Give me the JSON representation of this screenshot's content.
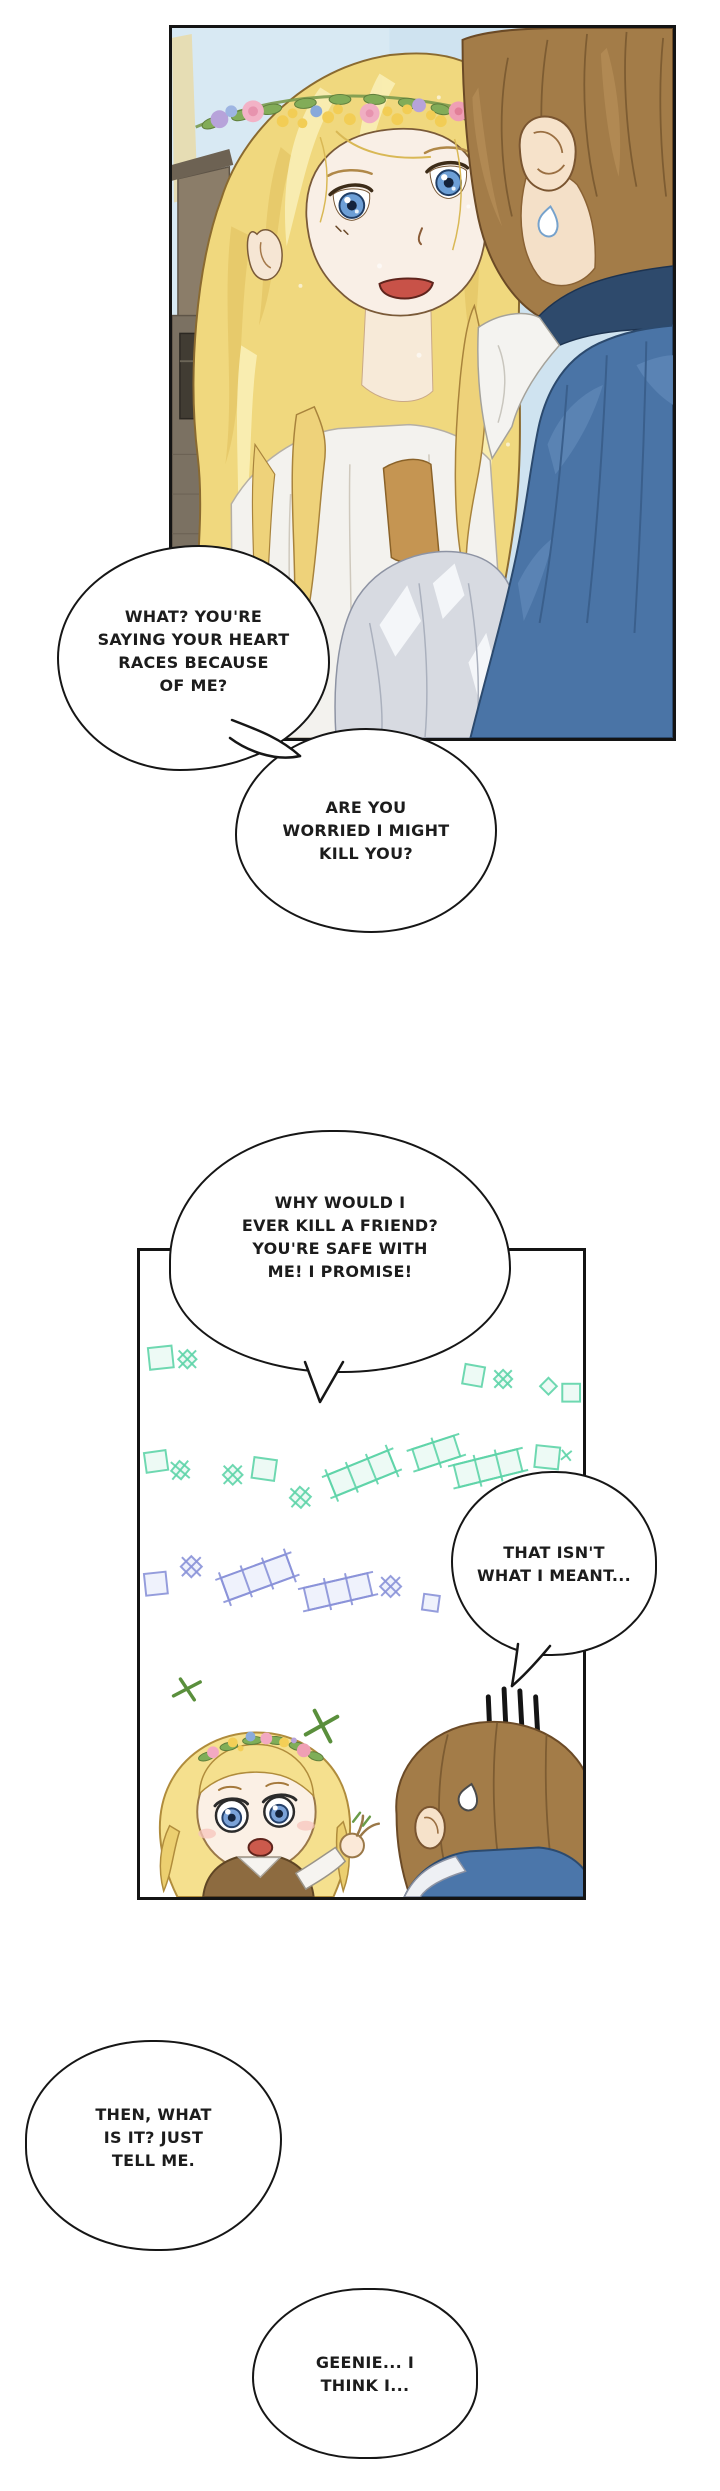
{
  "page": {
    "width": 720,
    "height": 2491,
    "background": "#ffffff"
  },
  "panels": [
    {
      "id": "panel-top",
      "content": "close-up of startled blonde woman with flower crown facing brown-haired man seen from behind"
    },
    {
      "id": "panel-chibi",
      "content": "chibi flower-crowned girl gesturing to sweating chibi boy among sparkles and trellis doodles"
    }
  ],
  "bubbles": [
    {
      "id": "bubble-1",
      "lines": [
        "WHAT? YOU'RE",
        "SAYING YOUR HEART",
        "RACES BECAUSE",
        "OF ME?"
      ]
    },
    {
      "id": "bubble-2",
      "lines": [
        "ARE YOU",
        "WORRIED I MIGHT",
        "KILL YOU?"
      ]
    },
    {
      "id": "bubble-3",
      "lines": [
        "WHY WOULD I",
        "EVER KILL A FRIEND?",
        "YOU'RE SAFE WITH",
        "ME! I PROMISE!"
      ]
    },
    {
      "id": "bubble-4",
      "lines": [
        "THAT ISN'T",
        "WHAT I MEANT..."
      ]
    },
    {
      "id": "bubble-5",
      "lines": [
        "THEN, WHAT",
        "IS IT? JUST",
        "TELL ME."
      ]
    },
    {
      "id": "bubble-6",
      "lines": [
        "GEENIE... I",
        "THINK I..."
      ]
    }
  ],
  "palette": {
    "outline": "#161616",
    "sky_blue": "#cfe3f0",
    "hair_gold": "#f0d87e",
    "hair_gold_highlight": "#f9efb6",
    "skin": "#f9efe6",
    "eye_blue": "#6d9fd6",
    "mouth_red": "#c85248",
    "man_hair_brown": "#a37c48",
    "cape_blue": "#4a74a6",
    "collar_navy": "#2e4a6c",
    "sleeve_gray": "#d7dae1",
    "vest_gold": "#c59552",
    "trellis_mint": "#5ed4a8",
    "trellis_periwinkle": "#8a92d8",
    "sparkle_green": "#5a8f3c"
  }
}
